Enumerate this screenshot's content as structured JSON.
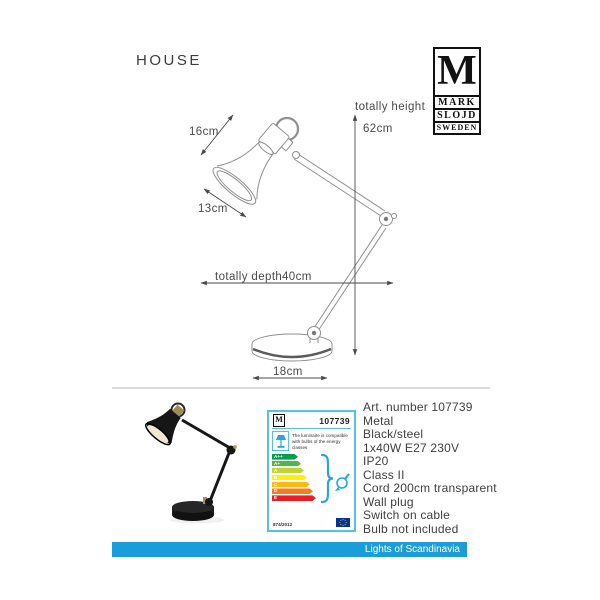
{
  "page": {
    "title": "HOUSE"
  },
  "brand": {
    "logo_m": "M",
    "line1": "MARK",
    "line2": "SLÖJD",
    "line3": "SWEDEN"
  },
  "diagram": {
    "shade_height_label": "16cm",
    "shade_width_label": "13cm",
    "height_label": "totally height",
    "height_value": "62cm",
    "depth_label": "totally depth",
    "depth_value": "40cm",
    "base_label": "18cm"
  },
  "energy_label": {
    "logo_m": "M",
    "art_number": "107739",
    "compat_text": "The luminaire is compatible with bulbs of the energy classes",
    "classes": [
      {
        "label": "A++",
        "color": "#00a14b"
      },
      {
        "label": "A+",
        "color": "#4db848"
      },
      {
        "label": "A",
        "color": "#bed630"
      },
      {
        "label": "B",
        "color": "#fff200"
      },
      {
        "label": "C",
        "color": "#fdb813"
      },
      {
        "label": "D",
        "color": "#f47b20"
      },
      {
        "label": "E",
        "color": "#ed1c24"
      }
    ],
    "regulation": "874/2012",
    "icons": {
      "pictogram": "table-lamp-icon",
      "brace": "brace-glyph",
      "bulb": "bulb-icon",
      "flag": "eu-flag-icon"
    }
  },
  "specs": {
    "lines": [
      "Art. number 107739",
      "Metal",
      "Black/steel",
      "1x40W E27 230V",
      "IP20",
      "Class II",
      "Cord 200cm transparent",
      "Wall plug",
      "Switch on cable",
      "Bulb not included"
    ]
  },
  "footer": {
    "banner_text": "Lights of Scandinavia",
    "banner_color": "#1b9dd9"
  }
}
